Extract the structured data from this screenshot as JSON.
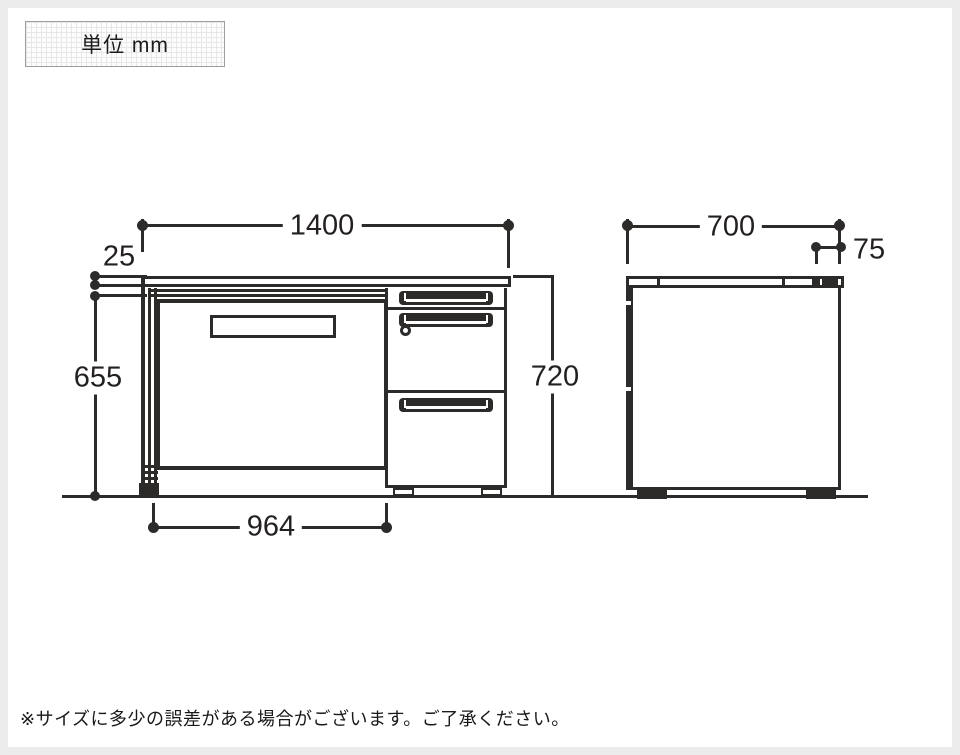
{
  "unit_box": {
    "label": "単位 mm"
  },
  "views": {
    "front": {
      "name": "desk front elevation",
      "dim_width": "1400",
      "dim_top_thickness": "25",
      "dim_underside_height": "655",
      "dim_total_height": "720",
      "dim_knee_space": "964"
    },
    "side": {
      "name": "desk side elevation",
      "dim_depth": "700",
      "dim_back_edge": "75"
    }
  },
  "footnote": "※サイズに多少の誤差がある場合がございます。ご了承ください。",
  "colors": {
    "ink": "#2d2a2a",
    "frame": "#ececec",
    "paper": "#ffffff"
  }
}
